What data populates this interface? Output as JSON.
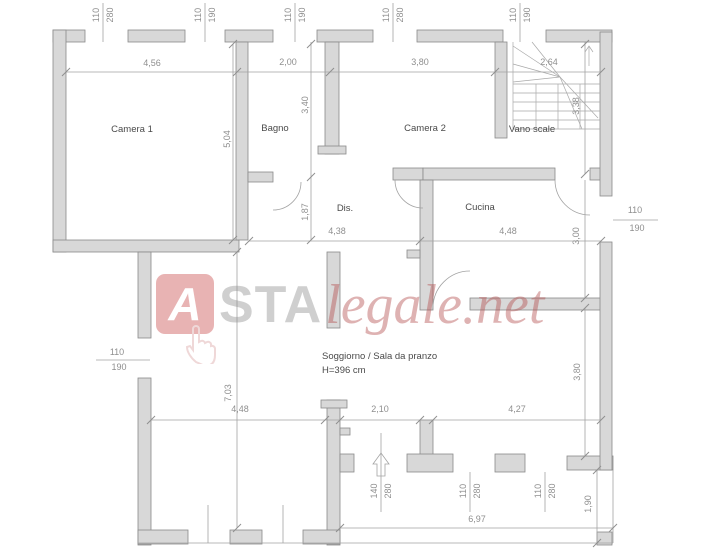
{
  "plan": {
    "rooms": [
      {
        "name": "Camera 1"
      },
      {
        "name": "Bagno"
      },
      {
        "name": "Camera 2"
      },
      {
        "name": "Vano scale"
      },
      {
        "name": "Dis."
      },
      {
        "name": "Cucina"
      },
      {
        "name": "Soggiorno / Sala da pranzo",
        "note": "H=396 cm"
      }
    ],
    "dims_h_top": [
      "4,56",
      "2,00",
      "3,80",
      "2,64"
    ],
    "dims_h_mid": [
      "4,38",
      "4,48"
    ],
    "dims_h_low": [
      "4,48",
      "2,10",
      "4,27"
    ],
    "dims_h_bottom": [
      "6,97"
    ],
    "dims_v": [
      "5,04",
      "3,40",
      "1,87",
      "3,38",
      "3,00",
      "3,80",
      "7,03",
      "1,90"
    ],
    "openings_top": [
      {
        "w": "110",
        "h": "280"
      },
      {
        "w": "110",
        "h": "190"
      },
      {
        "w": "110",
        "h": "190"
      },
      {
        "w": "110",
        "h": "280"
      },
      {
        "w": "110",
        "h": "190"
      }
    ],
    "opening_left": {
      "w": "110",
      "h": "190"
    },
    "opening_right": {
      "w": "110",
      "h": "190"
    },
    "openings_bottom": [
      {
        "w": "140",
        "h": "280"
      },
      {
        "w": "110",
        "h": "280"
      },
      {
        "w": "110",
        "h": "280"
      }
    ]
  },
  "watermark": {
    "letter": "A",
    "bold": "STA",
    "italic": "legale.net"
  },
  "colors": {
    "wall_fill": "#d8d8d8",
    "wall_stroke": "#8a8a8a",
    "dim_line": "#a3a3a3",
    "dim_text": "#8f8f8f",
    "label_text": "#4a4a4a",
    "watermark_red": "#b34a4a",
    "watermark_gray": "#8f8f8f"
  }
}
